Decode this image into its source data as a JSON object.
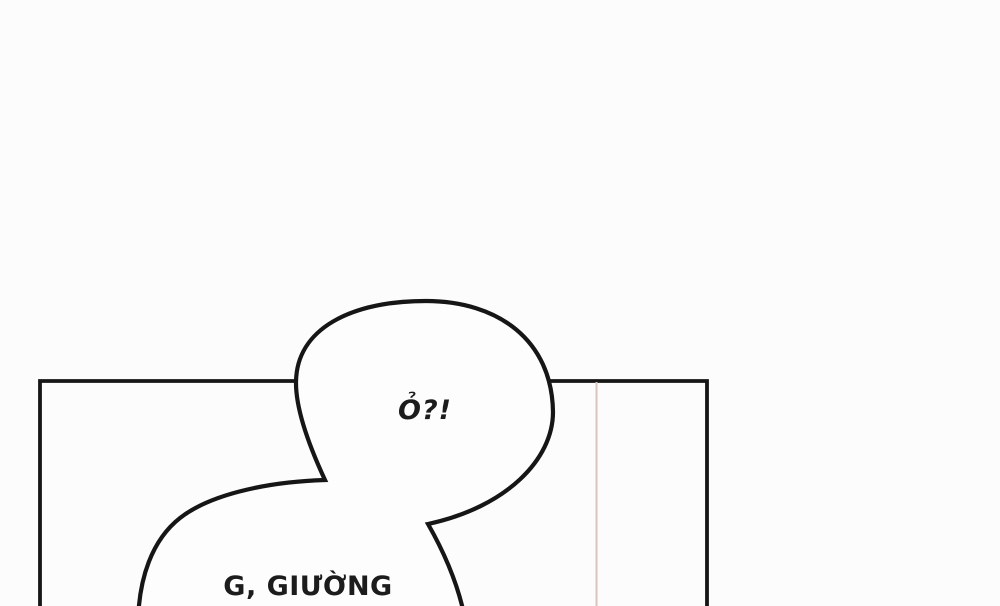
{
  "artwork": {
    "kind": "comic-panel",
    "colors": {
      "background": "#fcfcfc",
      "ink": "#161616",
      "bubble_fill": "#fdfdfd",
      "wall_line": "#d9c6bb"
    },
    "bubbles": {
      "top_text": "Ỏ?!",
      "bottom_text": "G, GIƯỜNG"
    }
  }
}
